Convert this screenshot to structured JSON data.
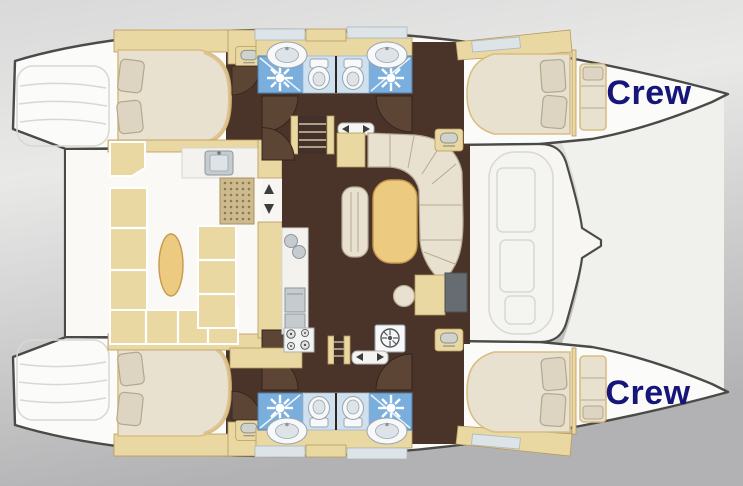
{
  "labels": {
    "crew_top": "Crew",
    "crew_bottom": "Crew"
  },
  "palette": {
    "background_top": "#d9d9d9",
    "background_mid": "#e9e9e8",
    "background_bottom": "#b2b2b4",
    "hull_fill": "#fbfbf9",
    "hull_outline": "#4a4a48",
    "bridge_fill": "#f7f6f2",
    "trampoline_fill": "#f0f0ed",
    "deck_line": "#d8d8d2",
    "foredeck_fill": "#f4f4f0",
    "wood_floor": "#4a342a",
    "wood_floor_dark": "#42302a",
    "wall_dark": "#33241b",
    "door_leaf": "#5c4534",
    "cabinet_tan": "#e9d8a2",
    "cabinet_border": "#b99a5e",
    "upholstery_cream": "#e8e1d0",
    "upholstery_edge": "#b6ab92",
    "bed_rim": "#d9bd82",
    "table_tan": "#ecca80",
    "table_edge": "#c49a4e",
    "tile_blue": "#79aedd",
    "tile_pale": "#cfe0ef",
    "fixture_white": "#f6f8f9",
    "fixture_inner": "#dde3e7",
    "fixture_grey": "#9aa4ac",
    "appliance_grey": "#c6cbcf",
    "desk_grey": "#676c72",
    "window_pane": "#dde4e8",
    "crew_text": "#16167a"
  }
}
